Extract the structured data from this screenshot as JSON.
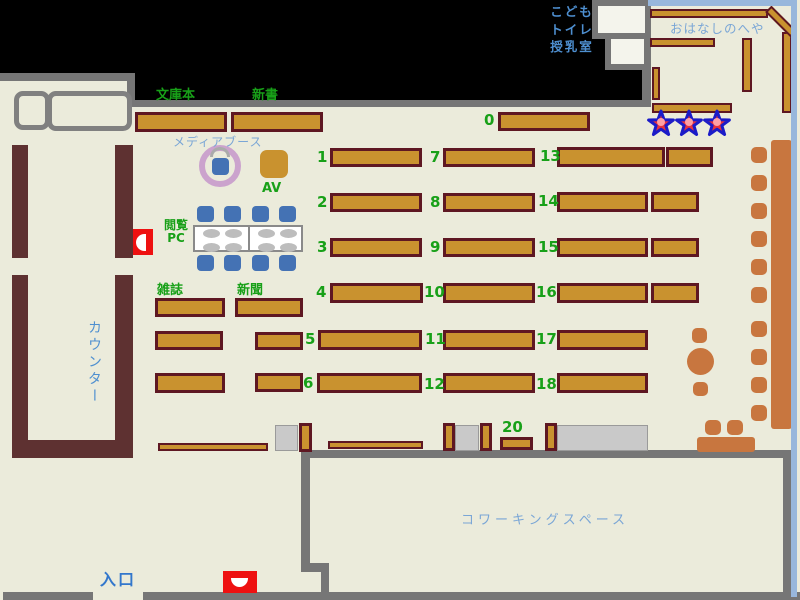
{
  "title": "Library floor map",
  "palette": {
    "floor": "#EBEBDB",
    "black": "#000000",
    "wall_gray": "#767676",
    "wall_maroon": "#5E3131",
    "shelf_fill": "#C9922F",
    "shelf_border": "#5E1722",
    "orange": "#C8763F",
    "chair_blue": "#4472B4",
    "gray_box": "#C9C9C9",
    "gray_box_border": "#9A9A9A",
    "table_border": "#8A8A8A",
    "pad_gray": "#BDBDBD",
    "ring_plum": "#CBA3CD",
    "star_red": "#E8323C",
    "star_blue": "#1B1BC8",
    "star_pink": "#FFA0A4",
    "red_alert": "#EE1111",
    "blue_border": "#98B7DC",
    "room_white": "#F4F4EC",
    "green_text": "#18A018",
    "blue_mid": "#4E8FD0",
    "blue_light": "#7AA6D6",
    "blue_strong": "#3377CC"
  },
  "labels": {
    "bunkobon": {
      "text": "文庫本"
    },
    "shinsho": {
      "text": "新書"
    },
    "media_booth": {
      "text": "メディアブース"
    },
    "av": {
      "text": "AV"
    },
    "etsuran_pc": {
      "text": "閲覧\nPC"
    },
    "zasshi": {
      "text": "雑誌"
    },
    "shinbun": {
      "text": "新聞"
    },
    "counter": {
      "text": "カウンター"
    },
    "entrance": {
      "text": "入口"
    },
    "coworking": {
      "text": "コワーキングスペース"
    },
    "kids_room": {
      "text": "こども\nトイレ\n授乳室"
    },
    "ohanashi": {
      "text": "おはなしのへや"
    }
  },
  "map": {
    "black_areas": [
      {
        "x": 0,
        "y": 0,
        "w": 651,
        "h": 73
      },
      {
        "x": 135,
        "y": 73,
        "w": 516,
        "h": 27
      }
    ],
    "walls_gray": [
      {
        "x": 0,
        "y": 73,
        "w": 135,
        "h": 8
      },
      {
        "x": 127,
        "y": 73,
        "w": 8,
        "h": 34
      },
      {
        "x": 127,
        "y": 100,
        "w": 524,
        "h": 7
      },
      {
        "x": 642,
        "y": 0,
        "w": 9,
        "h": 107
      },
      {
        "x": 3,
        "y": 592,
        "w": 90,
        "h": 8
      },
      {
        "x": 143,
        "y": 592,
        "w": 657,
        "h": 8
      },
      {
        "x": 301,
        "y": 450,
        "w": 491,
        "h": 8
      },
      {
        "x": 301,
        "y": 452,
        "w": 9,
        "h": 119
      },
      {
        "x": 301,
        "y": 563,
        "w": 28,
        "h": 9
      },
      {
        "x": 321,
        "y": 570,
        "w": 8,
        "h": 24
      },
      {
        "x": 783,
        "y": 452,
        "w": 9,
        "h": 144
      }
    ],
    "walls_maroon": [
      {
        "x": 12,
        "y": 145,
        "w": 16,
        "h": 113
      },
      {
        "x": 115,
        "y": 145,
        "w": 18,
        "h": 113
      },
      {
        "x": 12,
        "y": 275,
        "w": 16,
        "h": 183
      },
      {
        "x": 115,
        "y": 275,
        "w": 18,
        "h": 183
      },
      {
        "x": 12,
        "y": 440,
        "w": 121,
        "h": 18
      }
    ],
    "kids_boxes": [
      {
        "x": 592,
        "y": 0,
        "w": 59,
        "h": 39
      },
      {
        "x": 605,
        "y": 33,
        "w": 45,
        "h": 37
      }
    ],
    "ohanashi_borders": [
      {
        "x": 648,
        "y": 0,
        "w": 149,
        "h": 6
      },
      {
        "x": 791,
        "y": 0,
        "w": 6,
        "h": 597
      }
    ],
    "shelves": [
      {
        "x": 135,
        "y": 112,
        "w": 92,
        "h": 20
      },
      {
        "x": 231,
        "y": 112,
        "w": 92,
        "h": 20
      },
      {
        "x": 498,
        "y": 112,
        "w": 92,
        "h": 19
      },
      {
        "x": 330,
        "y": 148,
        "w": 92,
        "h": 19
      },
      {
        "x": 443,
        "y": 148,
        "w": 92,
        "h": 19
      },
      {
        "x": 557,
        "y": 147,
        "w": 108,
        "h": 20
      },
      {
        "x": 666,
        "y": 147,
        "w": 47,
        "h": 20
      },
      {
        "x": 330,
        "y": 193,
        "w": 92,
        "h": 19
      },
      {
        "x": 443,
        "y": 193,
        "w": 92,
        "h": 19
      },
      {
        "x": 557,
        "y": 192,
        "w": 91,
        "h": 20
      },
      {
        "x": 651,
        "y": 192,
        "w": 48,
        "h": 20
      },
      {
        "x": 330,
        "y": 238,
        "w": 92,
        "h": 19
      },
      {
        "x": 443,
        "y": 238,
        "w": 92,
        "h": 19
      },
      {
        "x": 557,
        "y": 238,
        "w": 91,
        "h": 19
      },
      {
        "x": 651,
        "y": 238,
        "w": 48,
        "h": 19
      },
      {
        "x": 330,
        "y": 283,
        "w": 93,
        "h": 20
      },
      {
        "x": 443,
        "y": 283,
        "w": 92,
        "h": 20
      },
      {
        "x": 557,
        "y": 283,
        "w": 91,
        "h": 20
      },
      {
        "x": 651,
        "y": 283,
        "w": 48,
        "h": 20
      },
      {
        "x": 255,
        "y": 332,
        "w": 48,
        "h": 18
      },
      {
        "x": 318,
        "y": 330,
        "w": 104,
        "h": 20
      },
      {
        "x": 443,
        "y": 330,
        "w": 92,
        "h": 20
      },
      {
        "x": 557,
        "y": 330,
        "w": 91,
        "h": 20
      },
      {
        "x": 255,
        "y": 373,
        "w": 48,
        "h": 19
      },
      {
        "x": 317,
        "y": 373,
        "w": 105,
        "h": 20
      },
      {
        "x": 443,
        "y": 373,
        "w": 92,
        "h": 20
      },
      {
        "x": 557,
        "y": 373,
        "w": 91,
        "h": 20
      },
      {
        "x": 155,
        "y": 298,
        "w": 70,
        "h": 19
      },
      {
        "x": 235,
        "y": 298,
        "w": 68,
        "h": 19
      },
      {
        "x": 155,
        "y": 331,
        "w": 68,
        "h": 19
      },
      {
        "x": 155,
        "y": 373,
        "w": 70,
        "h": 20
      },
      {
        "x": 158,
        "y": 443,
        "w": 110,
        "h": 8
      },
      {
        "x": 328,
        "y": 441,
        "w": 95,
        "h": 8
      },
      {
        "x": 299,
        "y": 423,
        "w": 13,
        "h": 29
      },
      {
        "x": 443,
        "y": 423,
        "w": 12,
        "h": 28
      },
      {
        "x": 480,
        "y": 423,
        "w": 12,
        "h": 28
      },
      {
        "x": 545,
        "y": 423,
        "w": 12,
        "h": 28
      },
      {
        "x": 500,
        "y": 437,
        "w": 33,
        "h": 13
      },
      {
        "x": 650,
        "y": 9,
        "w": 118,
        "h": 9
      },
      {
        "x": 650,
        "y": 38,
        "w": 65,
        "h": 9
      },
      {
        "x": 652,
        "y": 67,
        "w": 8,
        "h": 33
      },
      {
        "x": 742,
        "y": 38,
        "w": 10,
        "h": 54
      },
      {
        "x": 652,
        "y": 103,
        "w": 80,
        "h": 10
      },
      {
        "x": 782,
        "y": 32,
        "w": 10,
        "h": 81
      },
      {
        "x": 763,
        "y": 17,
        "w": 36,
        "h": 9,
        "rot": 45
      }
    ],
    "shelf_numbers": [
      {
        "t": "0",
        "x": 484,
        "y": 110
      },
      {
        "t": "1",
        "x": 317,
        "y": 147
      },
      {
        "t": "7",
        "x": 430,
        "y": 147
      },
      {
        "t": "13",
        "x": 540,
        "y": 146
      },
      {
        "t": "2",
        "x": 317,
        "y": 192
      },
      {
        "t": "8",
        "x": 430,
        "y": 192
      },
      {
        "t": "14",
        "x": 538,
        "y": 191
      },
      {
        "t": "3",
        "x": 317,
        "y": 237
      },
      {
        "t": "9",
        "x": 430,
        "y": 237
      },
      {
        "t": "15",
        "x": 538,
        "y": 237
      },
      {
        "t": "4",
        "x": 316,
        "y": 282
      },
      {
        "t": "10",
        "x": 424,
        "y": 282
      },
      {
        "t": "16",
        "x": 536,
        "y": 282
      },
      {
        "t": "5",
        "x": 305,
        "y": 329
      },
      {
        "t": "11",
        "x": 425,
        "y": 329
      },
      {
        "t": "17",
        "x": 536,
        "y": 329
      },
      {
        "t": "6",
        "x": 303,
        "y": 373
      },
      {
        "t": "12",
        "x": 424,
        "y": 374
      },
      {
        "t": "18",
        "x": 536,
        "y": 374
      },
      {
        "t": "20",
        "x": 502,
        "y": 417
      }
    ],
    "gray_boxes": [
      {
        "x": 275,
        "y": 425,
        "w": 23,
        "h": 26
      },
      {
        "x": 455,
        "y": 425,
        "w": 24,
        "h": 26
      },
      {
        "x": 557,
        "y": 425,
        "w": 91,
        "h": 26
      }
    ],
    "orange_benches": [
      {
        "x": 771,
        "y": 140,
        "w": 21,
        "h": 289
      },
      {
        "x": 697,
        "y": 437,
        "w": 58,
        "h": 15
      }
    ],
    "orange_chairs": [
      {
        "x": 751,
        "y": 147,
        "w": 16,
        "h": 16
      },
      {
        "x": 751,
        "y": 175,
        "w": 16,
        "h": 16
      },
      {
        "x": 751,
        "y": 203,
        "w": 16,
        "h": 16
      },
      {
        "x": 751,
        "y": 231,
        "w": 16,
        "h": 16
      },
      {
        "x": 751,
        "y": 259,
        "w": 16,
        "h": 16
      },
      {
        "x": 751,
        "y": 287,
        "w": 16,
        "h": 16
      },
      {
        "x": 751,
        "y": 321,
        "w": 16,
        "h": 16
      },
      {
        "x": 751,
        "y": 349,
        "w": 16,
        "h": 16
      },
      {
        "x": 751,
        "y": 377,
        "w": 16,
        "h": 16
      },
      {
        "x": 751,
        "y": 405,
        "w": 16,
        "h": 16
      },
      {
        "x": 692,
        "y": 328,
        "w": 15,
        "h": 15
      },
      {
        "x": 693,
        "y": 382,
        "w": 15,
        "h": 14
      },
      {
        "x": 705,
        "y": 420,
        "w": 16,
        "h": 15
      },
      {
        "x": 727,
        "y": 420,
        "w": 16,
        "h": 15
      }
    ],
    "round_table": {
      "x": 687,
      "y": 348,
      "w": 27,
      "h": 27
    },
    "blue_chairs": [
      {
        "x": 197,
        "y": 206,
        "w": 17,
        "h": 16
      },
      {
        "x": 224,
        "y": 206,
        "w": 17,
        "h": 16
      },
      {
        "x": 252,
        "y": 206,
        "w": 17,
        "h": 16
      },
      {
        "x": 279,
        "y": 206,
        "w": 17,
        "h": 16
      },
      {
        "x": 197,
        "y": 255,
        "w": 17,
        "h": 16
      },
      {
        "x": 224,
        "y": 255,
        "w": 17,
        "h": 16
      },
      {
        "x": 252,
        "y": 255,
        "w": 17,
        "h": 16
      },
      {
        "x": 279,
        "y": 255,
        "w": 17,
        "h": 16
      },
      {
        "x": 212,
        "y": 158,
        "w": 17,
        "h": 17
      }
    ],
    "desks": [
      {
        "x": 14,
        "y": 91,
        "w": 36,
        "h": 39
      },
      {
        "x": 47,
        "y": 91,
        "w": 85,
        "h": 40
      }
    ],
    "pc_table": {
      "x": 193,
      "y": 225,
      "w": 110,
      "h": 27,
      "divider_x": 53,
      "pads": [
        {
          "x": 8,
          "y": 2
        },
        {
          "x": 30,
          "y": 2
        },
        {
          "x": 63,
          "y": 2
        },
        {
          "x": 85,
          "y": 2
        },
        {
          "x": 8,
          "y": 16
        },
        {
          "x": 30,
          "y": 16
        },
        {
          "x": 63,
          "y": 16
        },
        {
          "x": 85,
          "y": 16
        }
      ],
      "pad_w": 17,
      "pad_h": 9
    },
    "media_ring": {
      "x": 199,
      "y": 145,
      "w": 42,
      "h": 42
    },
    "media_arc": {
      "x": 210,
      "y": 147,
      "w": 20,
      "h": 10
    },
    "av_box": {
      "x": 260,
      "y": 150,
      "w": 28,
      "h": 28
    },
    "stars": [
      {
        "x": 646,
        "y": 108
      },
      {
        "x": 674,
        "y": 108
      },
      {
        "x": 702,
        "y": 108
      }
    ],
    "extinguishers": [
      {
        "x": 133,
        "y": 229,
        "w": 20,
        "h": 26,
        "inner": {
          "dx": 3,
          "dy": 5,
          "w": 10,
          "h": 17,
          "r": "9px 0 0 9px"
        }
      },
      {
        "x": 223,
        "y": 571,
        "w": 34,
        "h": 22,
        "inner": {
          "dx": 8,
          "dy": 7,
          "w": 17,
          "h": 9,
          "r": "0 0 9px 9px"
        }
      }
    ]
  }
}
